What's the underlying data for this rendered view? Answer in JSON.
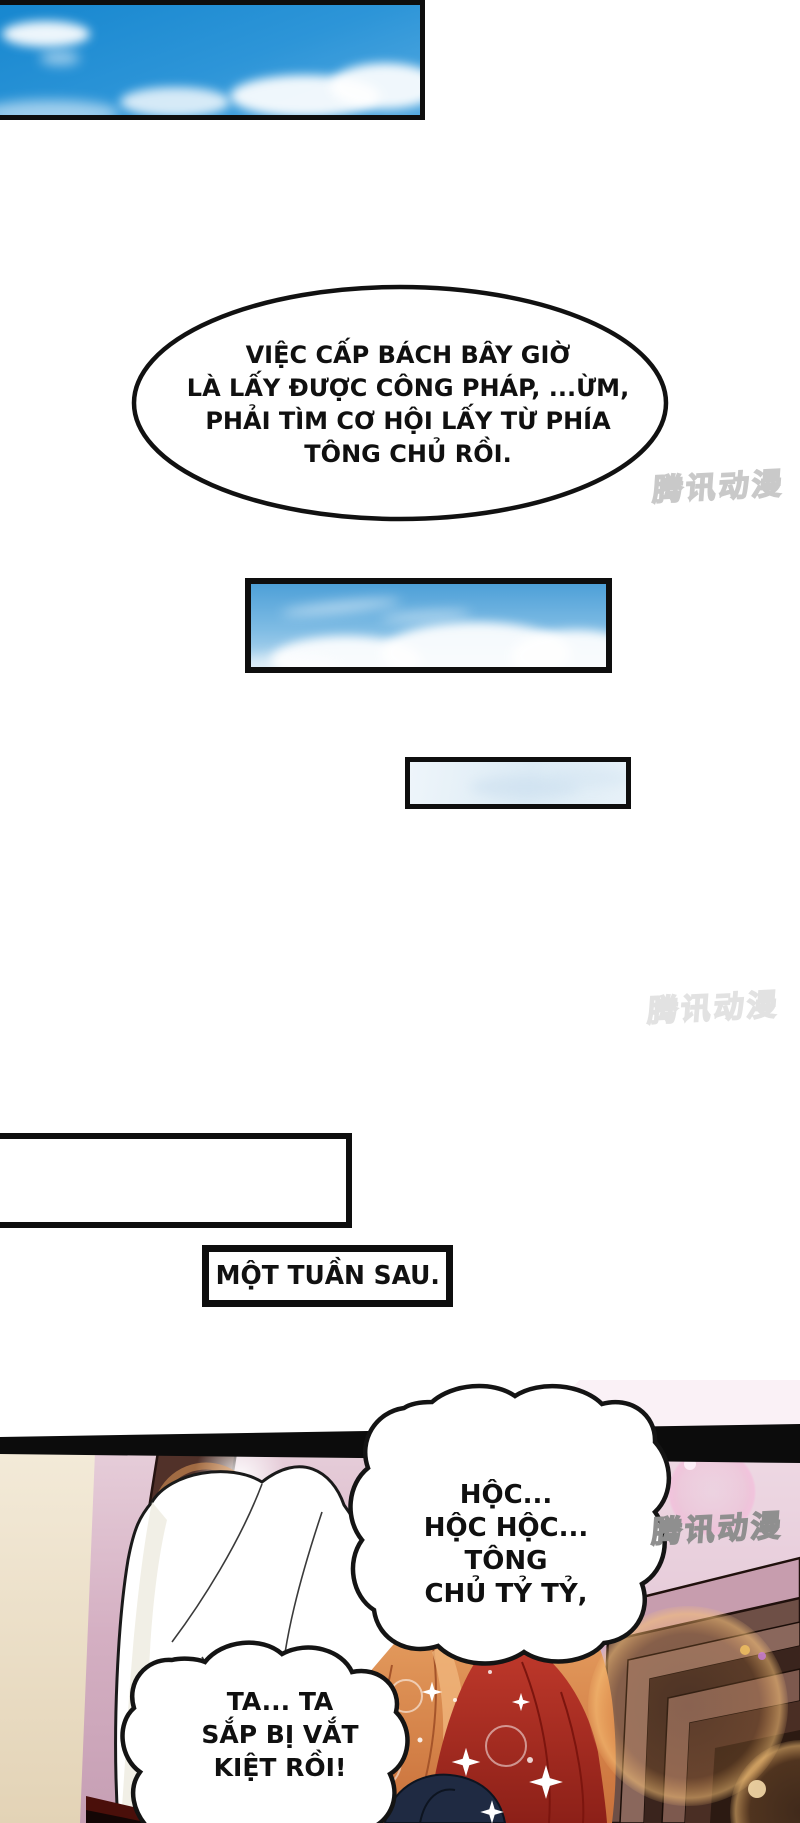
{
  "page": {
    "width": 800,
    "height": 1823,
    "background": "#ffffff"
  },
  "watermark": {
    "text": "腾讯动漫",
    "color_light": "#c9c9c9",
    "color_dark": "#8f8f8f"
  },
  "caption_box": {
    "text": "MỘT TUẦN SAU."
  },
  "bubbles": {
    "plan": {
      "lines": [
        "VIỆC CẤP BÁCH BÂY GIỜ",
        "LÀ LẤY ĐƯỢC CÔNG PHÁP, ...ỪM,",
        "PHẢI TÌM CƠ HỘI LẤY TỪ PHÍA",
        "TÔNG CHỦ RỒI."
      ]
    },
    "gasp": {
      "lines": [
        "HỘC...",
        "HỘC HỘC... TÔNG",
        "CHỦ TỶ TỶ,"
      ]
    },
    "drained": {
      "lines": [
        "TA... TA",
        "SẮP BỊ VẮT",
        "KIỆT RỒI!"
      ]
    }
  },
  "colors": {
    "sky_blue": "#2d95d8",
    "sky_pale": "#e7f1f8",
    "panel_border": "#0e0e0e",
    "bottom_bg_pink": "#cfa9bb",
    "beam_brown": "#513129",
    "headboard_brown": "#6e4f46",
    "headboard_top_mauve": "#c79dae",
    "hair_orange": "#d98a50",
    "fabric_red": "#a82c20",
    "hair_navy": "#1f2a42",
    "bokeh_orange": "#f0b26e",
    "flare_pink": "#eeaccd"
  }
}
